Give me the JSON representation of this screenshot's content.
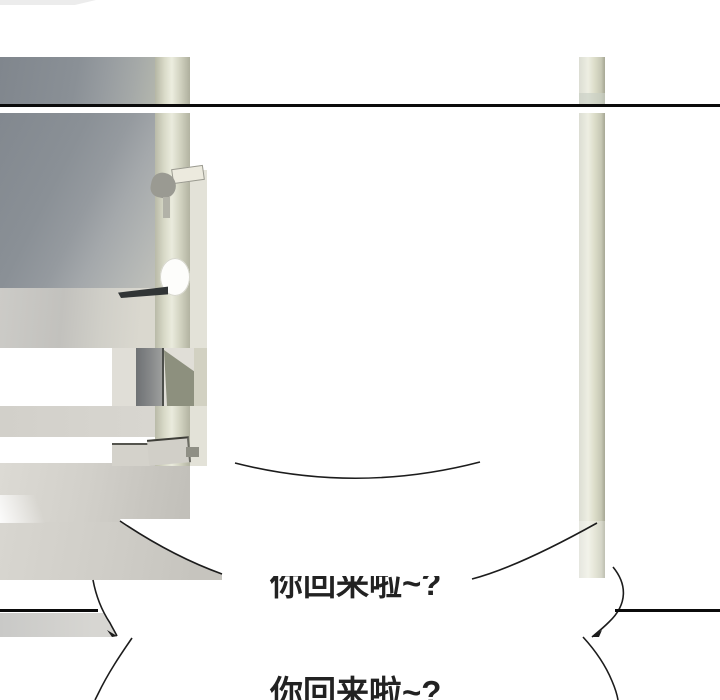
{
  "page": {
    "kind": "webtoon-comic-panel",
    "background": "#ffffff"
  },
  "bubbles": [
    {
      "text": "你回来啦~?"
    },
    {
      "text": "你回来啦~?"
    }
  ],
  "colors": {
    "ink": "#1c1c1c",
    "panel_line": "#0b0b0b",
    "text": "#222222",
    "door_gray_dark": "#82888f",
    "door_gray_light": "#c9c9c1",
    "door_frame_beige": "#eaebdd",
    "pole_beige": "#dcddc9",
    "glitch_olive": "#8d907e",
    "glitch_dark": "#6e7174"
  }
}
